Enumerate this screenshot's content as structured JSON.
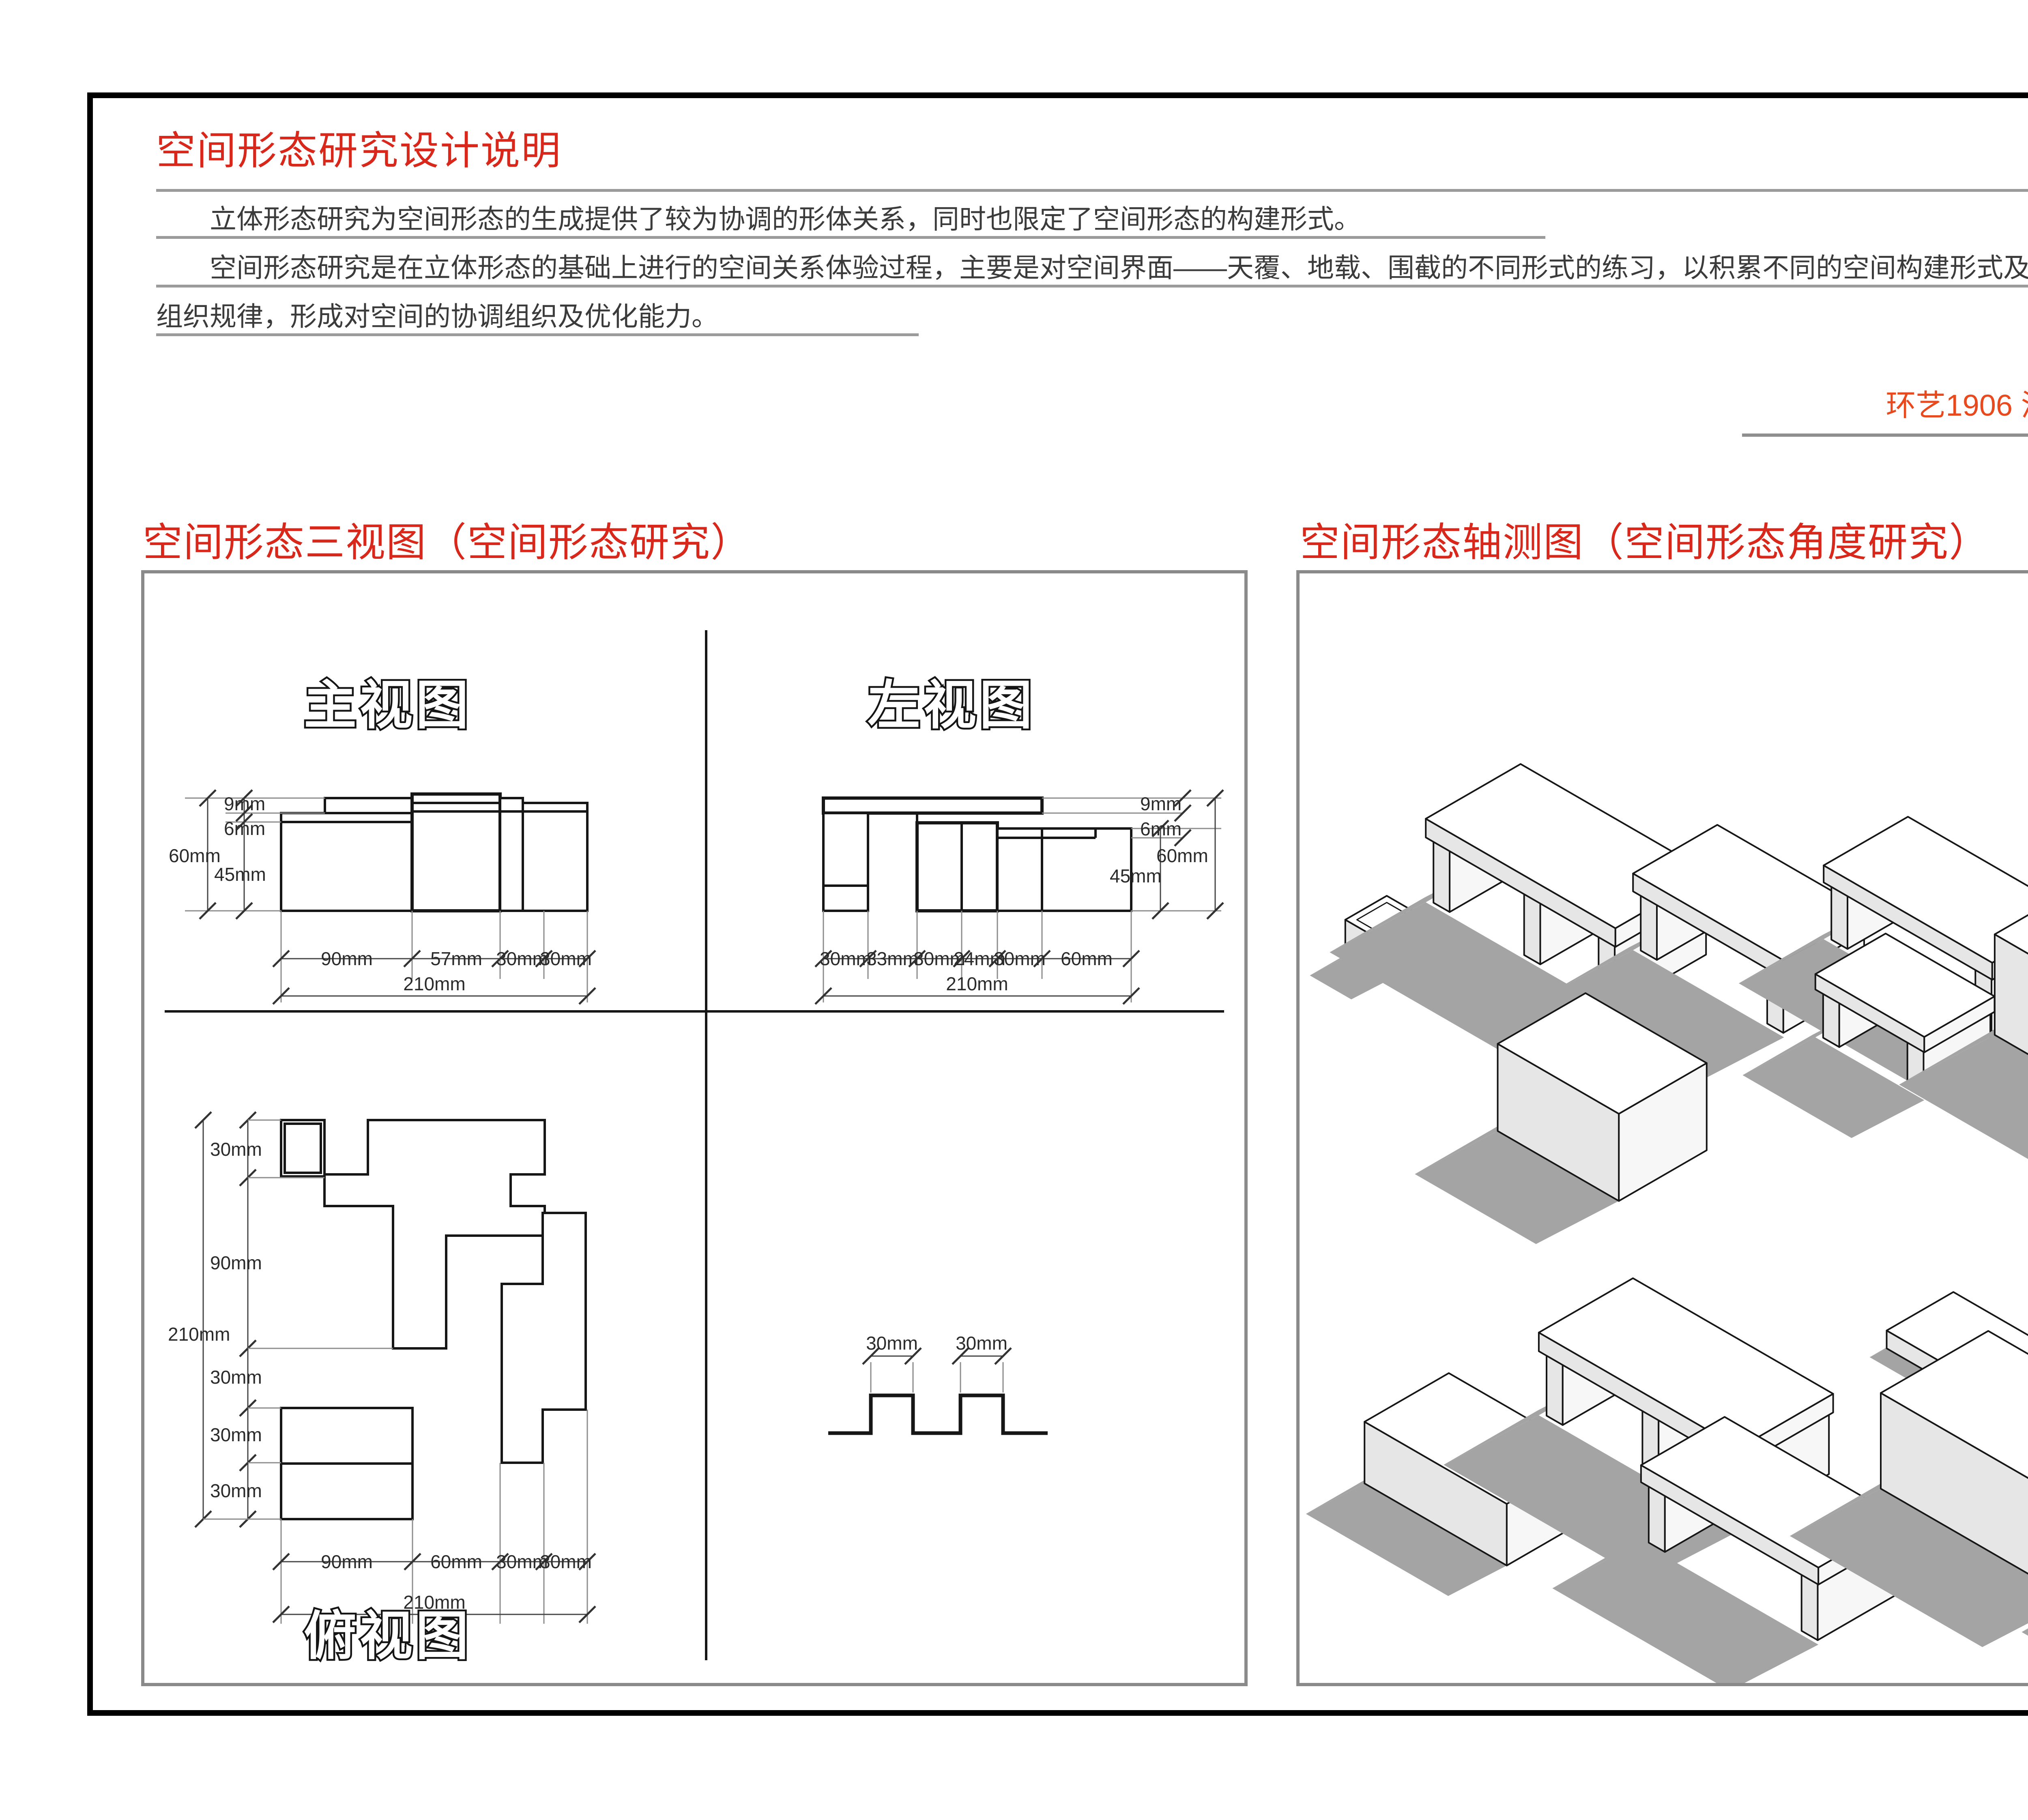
{
  "colors": {
    "heading_red": "#d7281b",
    "author_orange": "#e8491d",
    "body_text": "#3b3b3b",
    "rule_gray": "#9b9b9b",
    "panel_border_gray": "#8a8a8a",
    "drawing_line": "#161616",
    "shadow_gray": "#a4a4a4"
  },
  "header": {
    "title": "空间形态研究设计说明",
    "paragraph1": "立体形态研究为空间形态的生成提供了较为协调的形体关系，同时也限定了空间形态的构建形式。",
    "paragraph2": "空间形态研究是在立体形态的基础上进行的空间关系体验过程，主要是对空间界面——天覆、地载、围截的不同形式的练习，以积累不同的空间构建形式及其",
    "paragraph3": "组织规律，形成对空间的协调组织及优化能力。",
    "author_line": "环艺1906  潘雅轩   201940283"
  },
  "sections": {
    "three_view_heading": "空间形态三视图（空间形态研究）",
    "axon_heading": "空间形态轴测图（空间形态角度研究）"
  },
  "front_view": {
    "label": "主视图",
    "dim_9": "9mm",
    "dim_6": "6mm",
    "dim_60": "60mm",
    "dim_45": "45mm",
    "bottom_dims": [
      "90mm",
      "57mm",
      "30mm",
      "30mm"
    ],
    "total": "210mm"
  },
  "left_view": {
    "label": "左视图",
    "dim_9": "9mm",
    "dim_6": "6mm",
    "dim_60": "60mm",
    "dim_45": "45mm",
    "bottom_dims": [
      "30mm",
      "33mm",
      "30mm",
      "24mm",
      "30mm",
      "60mm"
    ],
    "total": "210mm"
  },
  "top_view": {
    "label": "俯视图",
    "left_dims": [
      "30mm",
      "90mm",
      "30mm",
      "30mm",
      "30mm"
    ],
    "left_total": "210mm",
    "bottom_dims": [
      "90mm",
      "60mm",
      "30mm",
      "30mm"
    ],
    "total": "210mm"
  },
  "profile": {
    "dims": [
      "30mm",
      "30mm"
    ]
  }
}
